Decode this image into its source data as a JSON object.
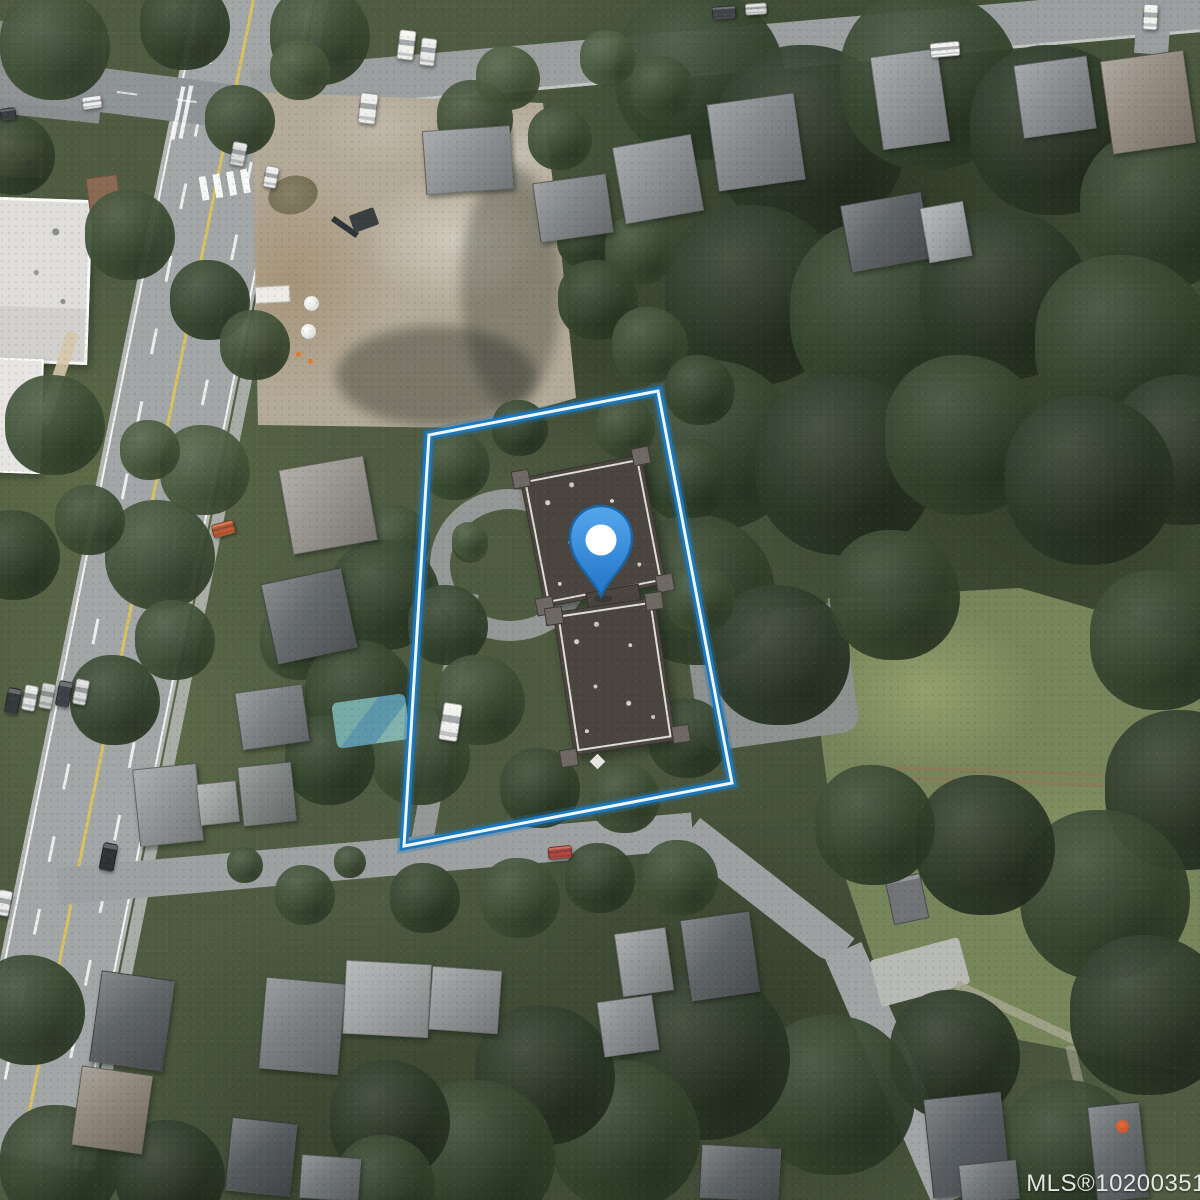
{
  "map": {
    "view_label": "satellite-aerial-view",
    "watermark": {
      "text": "MLS®10200351",
      "color": "#f1f2ef"
    },
    "boundary": {
      "label": "property-boundary",
      "stroke_glow": "rgba(32,120,190,0.30)",
      "stroke_outer": "#1d79bd",
      "stroke_inner": "#eef6fc",
      "points": "429,435 658,391 732,783 404,846"
    },
    "pin": {
      "label": "property-location-pin",
      "body_top": "#55a7ec",
      "body_bottom": "#2174c8",
      "outline": "#1a66a8",
      "dot": "#ffffff"
    }
  },
  "scene": {
    "tree_palette": [
      "#2c3927",
      "#35452e",
      "#3e4f35",
      "#48593c",
      "#536445"
    ],
    "houses": [
      [
        618,
        140,
        78,
        76,
        -10,
        "#878b8e"
      ],
      [
        712,
        98,
        86,
        86,
        -8,
        "#7e8285"
      ],
      [
        876,
        52,
        66,
        92,
        -8,
        "#8b8f91"
      ],
      [
        1018,
        60,
        72,
        72,
        -8,
        "#85898b"
      ],
      [
        1106,
        55,
        82,
        92,
        -8,
        "#8f867a"
      ],
      [
        845,
        198,
        80,
        66,
        -10,
        "#565b5e"
      ],
      [
        924,
        204,
        42,
        54,
        -10,
        "#9da1a2"
      ],
      [
        424,
        128,
        86,
        62,
        -4,
        "#8a8e90"
      ],
      [
        536,
        178,
        72,
        58,
        -8,
        "#7c8183"
      ],
      [
        285,
        462,
        84,
        84,
        -10,
        "#94908a"
      ],
      [
        268,
        575,
        80,
        80,
        -12,
        "#5d6264"
      ],
      [
        238,
        688,
        66,
        56,
        -8,
        "#767b7d"
      ],
      [
        136,
        766,
        62,
        76,
        -6,
        "#8e9192"
      ],
      [
        198,
        782,
        38,
        40,
        -6,
        "#9b9e9e"
      ],
      [
        240,
        764,
        52,
        58,
        -6,
        "#7a807e"
      ],
      [
        95,
        975,
        72,
        90,
        8,
        "#575c5f"
      ],
      [
        76,
        1070,
        70,
        78,
        8,
        "#898073"
      ],
      [
        262,
        980,
        78,
        90,
        5,
        "#75797b"
      ],
      [
        344,
        962,
        84,
        72,
        3,
        "#9da0a1"
      ],
      [
        430,
        968,
        68,
        62,
        4,
        "#8d9091"
      ],
      [
        228,
        1120,
        64,
        72,
        6,
        "#4d5255"
      ],
      [
        300,
        1156,
        58,
        42,
        4,
        "#6b7072"
      ],
      [
        700,
        1146,
        78,
        52,
        3,
        "#555a5c"
      ],
      [
        685,
        915,
        68,
        80,
        -8,
        "#575c5f"
      ],
      [
        618,
        930,
        50,
        62,
        -8,
        "#8d9091"
      ],
      [
        600,
        998,
        54,
        54,
        -8,
        "#83878a"
      ],
      [
        928,
        1095,
        76,
        98,
        -6,
        "#51565a"
      ],
      [
        1092,
        1104,
        50,
        94,
        -6,
        "#5e6366"
      ],
      [
        960,
        1162,
        56,
        38,
        -6,
        "#696e70"
      ]
    ],
    "trees": [
      [
        700,
        75,
        85,
        1
      ],
      [
        810,
        140,
        95,
        0
      ],
      [
        930,
        80,
        90,
        1
      ],
      [
        1055,
        130,
        85,
        0
      ],
      [
        1160,
        210,
        80,
        1
      ],
      [
        755,
        295,
        90,
        0
      ],
      [
        885,
        315,
        95,
        1
      ],
      [
        1005,
        295,
        85,
        0
      ],
      [
        1125,
        345,
        90,
        1
      ],
      [
        1185,
        450,
        75,
        0
      ],
      [
        715,
        445,
        85,
        1
      ],
      [
        845,
        465,
        90,
        0
      ],
      [
        965,
        435,
        80,
        1
      ],
      [
        1090,
        480,
        85,
        0
      ],
      [
        700,
        590,
        75,
        1
      ],
      [
        780,
        655,
        70,
        0
      ],
      [
        895,
        595,
        65,
        1
      ],
      [
        1160,
        640,
        70,
        1
      ],
      [
        1185,
        790,
        80,
        0
      ],
      [
        1105,
        895,
        85,
        1
      ],
      [
        985,
        845,
        70,
        0
      ],
      [
        875,
        825,
        60,
        1
      ],
      [
        1150,
        1015,
        80,
        0
      ],
      [
        1070,
        1150,
        70,
        1
      ],
      [
        955,
        1055,
        65,
        0
      ],
      [
        835,
        1095,
        80,
        1
      ],
      [
        705,
        1055,
        85,
        0
      ],
      [
        625,
        1135,
        75,
        1
      ],
      [
        545,
        1075,
        70,
        0
      ],
      [
        480,
        1155,
        75,
        1
      ],
      [
        390,
        1120,
        60,
        0
      ],
      [
        320,
        35,
        50,
        2
      ],
      [
        185,
        25,
        45,
        1
      ],
      [
        55,
        45,
        55,
        2
      ],
      [
        15,
        155,
        40,
        1
      ],
      [
        130,
        235,
        45,
        2
      ],
      [
        210,
        300,
        40,
        1
      ],
      [
        255,
        345,
        35,
        2
      ],
      [
        55,
        425,
        50,
        2
      ],
      [
        15,
        555,
        45,
        1
      ],
      [
        160,
        555,
        55,
        2
      ],
      [
        205,
        470,
        45,
        3
      ],
      [
        395,
        540,
        35,
        2
      ],
      [
        385,
        595,
        55,
        1
      ],
      [
        300,
        640,
        40,
        2
      ],
      [
        360,
        695,
        55,
        1
      ],
      [
        420,
        755,
        50,
        2
      ],
      [
        330,
        760,
        45,
        1
      ],
      [
        175,
        640,
        40,
        2
      ],
      [
        115,
        700,
        45,
        1
      ],
      [
        455,
        465,
        35,
        2
      ],
      [
        448,
        625,
        40,
        1
      ],
      [
        480,
        700,
        45,
        2
      ],
      [
        540,
        788,
        40,
        1
      ],
      [
        625,
        798,
        35,
        2
      ],
      [
        688,
        738,
        40,
        1
      ],
      [
        700,
        598,
        35,
        2
      ],
      [
        692,
        478,
        40,
        1
      ],
      [
        625,
        428,
        30,
        2
      ],
      [
        520,
        428,
        28,
        1
      ],
      [
        470,
        540,
        18,
        3
      ],
      [
        520,
        898,
        40,
        2
      ],
      [
        600,
        878,
        35,
        1
      ],
      [
        680,
        878,
        38,
        2
      ],
      [
        425,
        898,
        35,
        1
      ],
      [
        305,
        895,
        30,
        2
      ],
      [
        475,
        118,
        38,
        2
      ],
      [
        508,
        78,
        32,
        3
      ],
      [
        560,
        138,
        32,
        2
      ],
      [
        608,
        58,
        28,
        3
      ],
      [
        662,
        88,
        32,
        2
      ],
      [
        585,
        240,
        28,
        1
      ],
      [
        640,
        250,
        35,
        2
      ],
      [
        598,
        300,
        40,
        1
      ],
      [
        650,
        345,
        38,
        2
      ],
      [
        700,
        390,
        35,
        1
      ],
      [
        240,
        120,
        35,
        2
      ],
      [
        300,
        70,
        30,
        3
      ],
      [
        150,
        450,
        30,
        3
      ],
      [
        90,
        520,
        35,
        2
      ],
      [
        30,
        1010,
        55,
        1
      ],
      [
        60,
        1165,
        60,
        1
      ],
      [
        170,
        1175,
        55,
        0
      ],
      [
        385,
        1185,
        50,
        1
      ],
      [
        245,
        865,
        18,
        2
      ],
      [
        350,
        862,
        16,
        2
      ]
    ],
    "cars": [
      [
        398,
        30,
        15,
        28,
        7,
        "#f1f1ee"
      ],
      [
        420,
        38,
        14,
        26,
        7,
        "#e9e9e6"
      ],
      [
        359,
        93,
        16,
        29,
        7,
        "#eeeeea"
      ],
      [
        930,
        42,
        28,
        13,
        -5,
        "#f2f2ef"
      ],
      [
        1143,
        4,
        13,
        24,
        3,
        "#f0f0ed"
      ],
      [
        712,
        6,
        22,
        11,
        -4,
        "#43474a"
      ],
      [
        745,
        3,
        20,
        10,
        -4,
        "#d7d8d5"
      ],
      [
        231,
        142,
        13,
        22,
        11,
        "#dcddda"
      ],
      [
        264,
        166,
        12,
        20,
        11,
        "#ecedec"
      ],
      [
        101,
        843,
        13,
        26,
        11,
        "#2d3133"
      ],
      [
        -3,
        890,
        12,
        24,
        11,
        "#e9eae8"
      ],
      [
        548,
        846,
        22,
        11,
        -6,
        "#b5463c"
      ],
      [
        441,
        703,
        17,
        36,
        9,
        "#f0f0ec"
      ],
      [
        212,
        522,
        21,
        12,
        -15,
        "#c05a2e"
      ],
      [
        82,
        96,
        18,
        11,
        -8,
        "#ecedec"
      ],
      [
        0,
        108,
        14,
        10,
        -8,
        "#3a3e40"
      ],
      [
        6,
        688,
        12,
        24,
        11,
        "#35393b"
      ],
      [
        23,
        685,
        12,
        24,
        11,
        "#e4e5e3"
      ],
      [
        40,
        683,
        12,
        24,
        11,
        "#c7c9c7"
      ],
      [
        57,
        681,
        12,
        24,
        11,
        "#3f4345"
      ],
      [
        74,
        679,
        12,
        24,
        11,
        "#d9dad8"
      ]
    ]
  }
}
